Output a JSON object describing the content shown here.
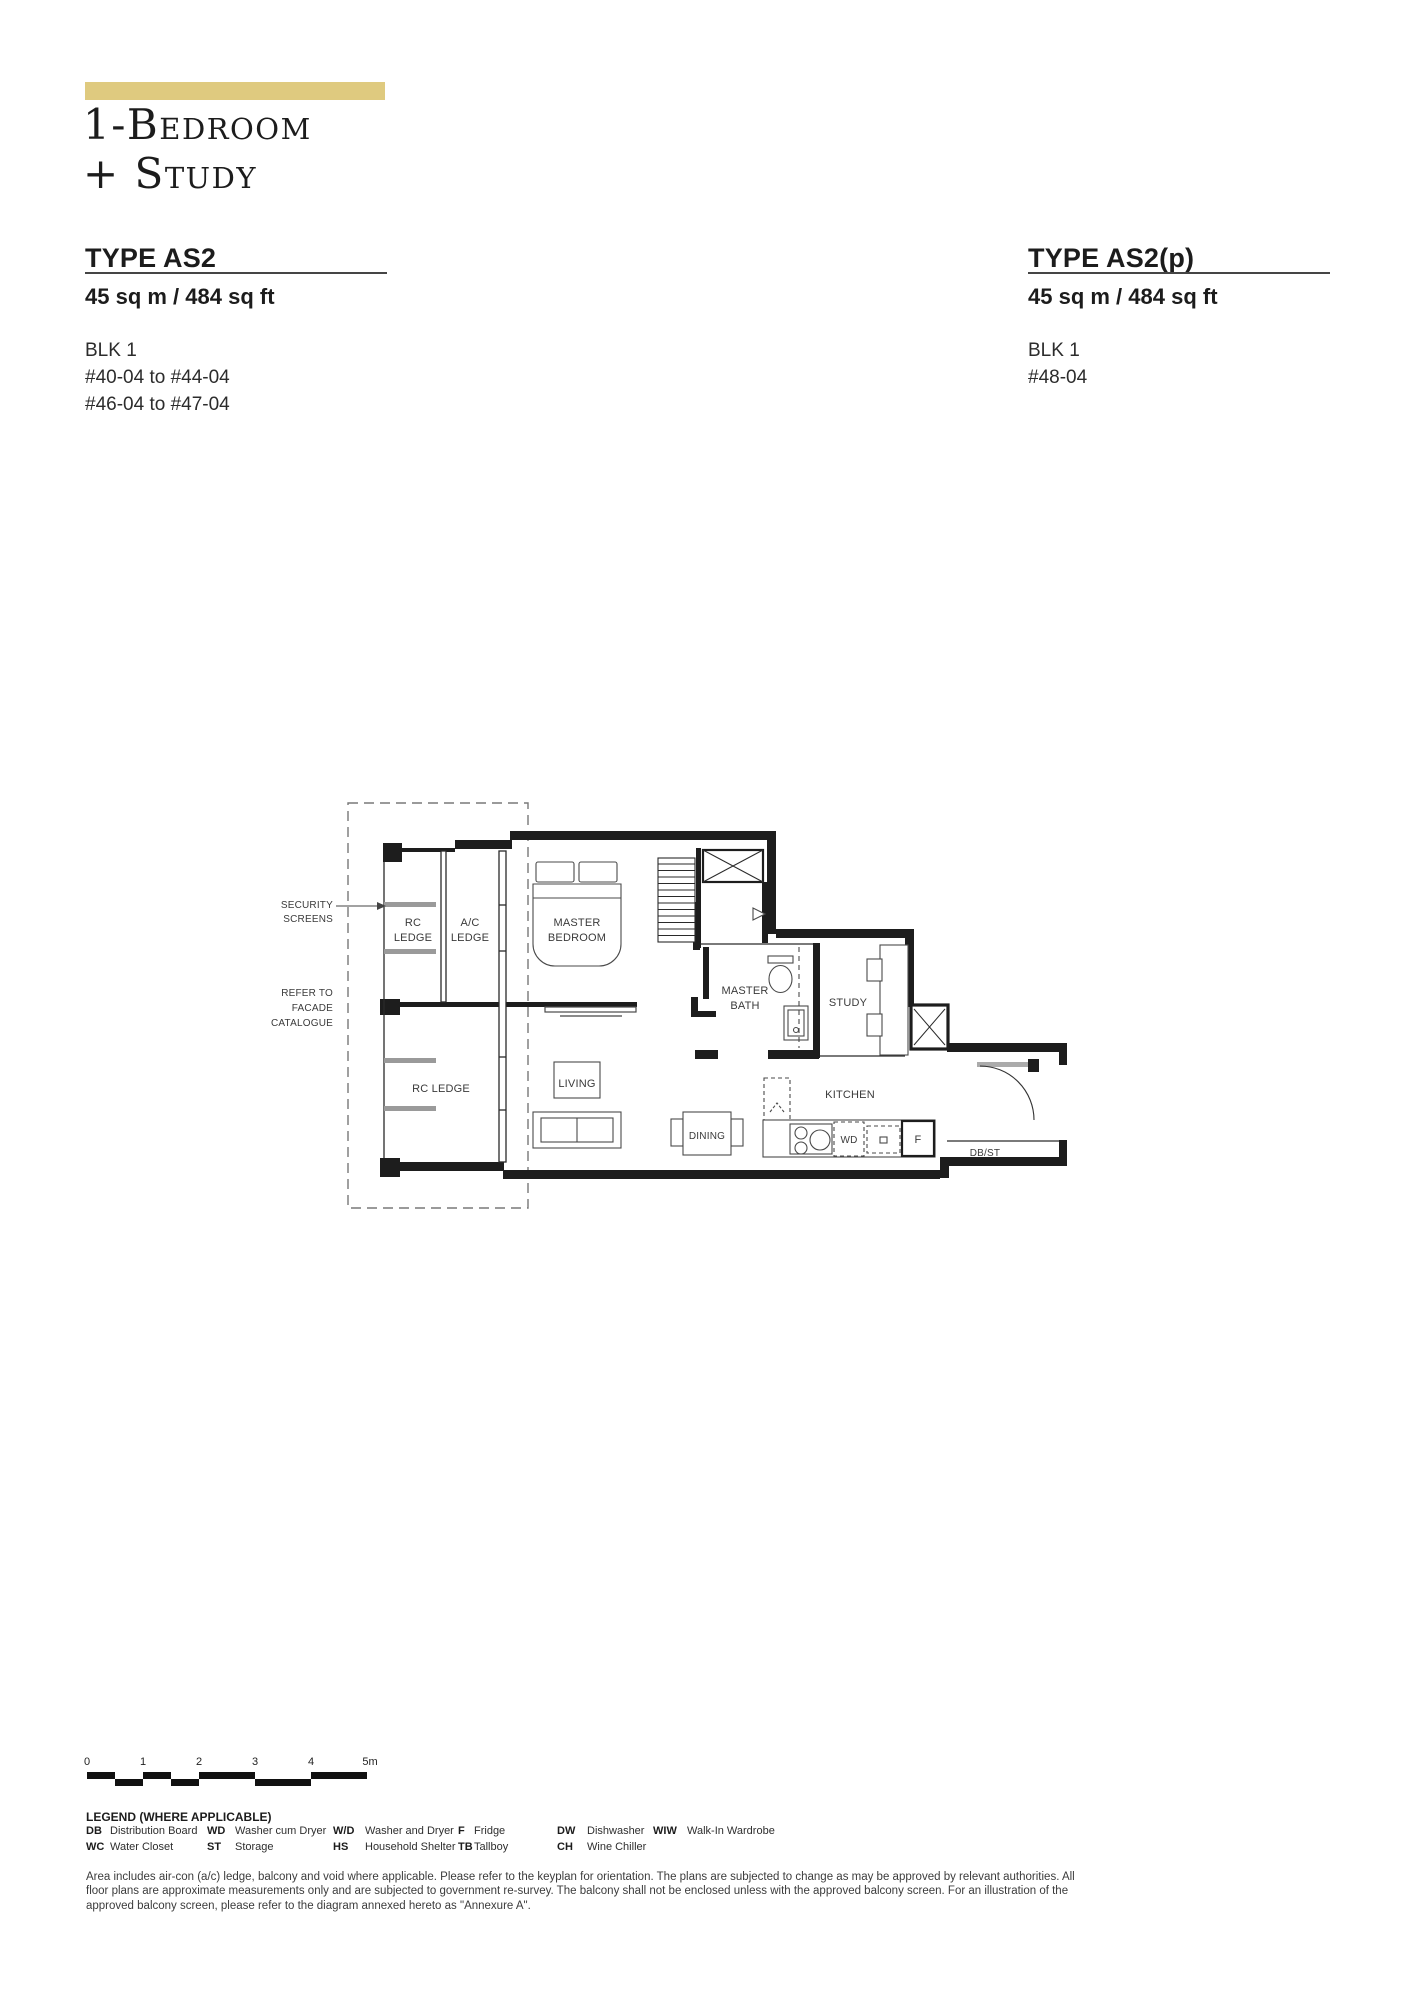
{
  "page": {
    "background": "#ffffff",
    "accent_color": "#dfca7f"
  },
  "header": {
    "title_line1": "1-Bedroom",
    "title_line2": "+ Study"
  },
  "units": {
    "left": {
      "type_label": "TYPE AS2",
      "area": "45 sq m / 484 sq ft",
      "block": "BLK 1",
      "stacks": [
        "#40-04 to #44-04",
        "#46-04 to #47-04"
      ]
    },
    "right": {
      "type_label": "TYPE AS2(p)",
      "area": "45 sq m / 484 sq ft",
      "block": "BLK 1",
      "stacks": [
        "#48-04"
      ]
    }
  },
  "plan": {
    "security_screens": [
      "SECURITY",
      "SCREENS"
    ],
    "refer_facade": [
      "REFER TO",
      "FACADE",
      "CATALOGUE"
    ],
    "rc_ledge_upper": [
      "RC",
      "LEDGE"
    ],
    "ac_ledge": [
      "A/C",
      "LEDGE"
    ],
    "master_bedroom": [
      "MASTER",
      "BEDROOM"
    ],
    "master_bath": [
      "MASTER",
      "BATH"
    ],
    "study": "STUDY",
    "rc_ledge_lower": "RC LEDGE",
    "living": "LIVING",
    "dining": "DINING",
    "kitchen": "KITCHEN",
    "washer_dryer": "WD",
    "fridge": "F",
    "db_st": "DB/ST"
  },
  "scalebar": {
    "ticks": [
      "0",
      "1",
      "2",
      "3",
      "4",
      "5m"
    ]
  },
  "legend": {
    "heading": "LEGEND (WHERE APPLICABLE)",
    "entries": [
      {
        "abbr": "DB",
        "label": "Distribution Board"
      },
      {
        "abbr": "WC",
        "label": "Water Closet"
      },
      {
        "abbr": "WD",
        "label": "Washer cum Dryer"
      },
      {
        "abbr": "ST",
        "label": "Storage"
      },
      {
        "abbr": "W/D",
        "label": "Washer and Dryer"
      },
      {
        "abbr": "HS",
        "label": "Household Shelter"
      },
      {
        "abbr": "F",
        "label": "Fridge"
      },
      {
        "abbr": "TB",
        "label": "Tallboy"
      },
      {
        "abbr": "DW",
        "label": "Dishwasher"
      },
      {
        "abbr": "CH",
        "label": "Wine Chiller"
      },
      {
        "abbr": "WIW",
        "label": "Walk-In Wardrobe"
      }
    ]
  },
  "disclaimer": "Area includes air-con (a/c) ledge, balcony and void where applicable. Please refer to the keyplan for orientation. The plans are subjected to change as may be approved by relevant authorities. All floor plans are approximate measurements only and are subjected to government re-survey. The balcony shall not be enclosed unless with the approved balcony screen. For an illustration of the approved balcony screen, please refer to the diagram annexed hereto as \"Annexure A\"."
}
